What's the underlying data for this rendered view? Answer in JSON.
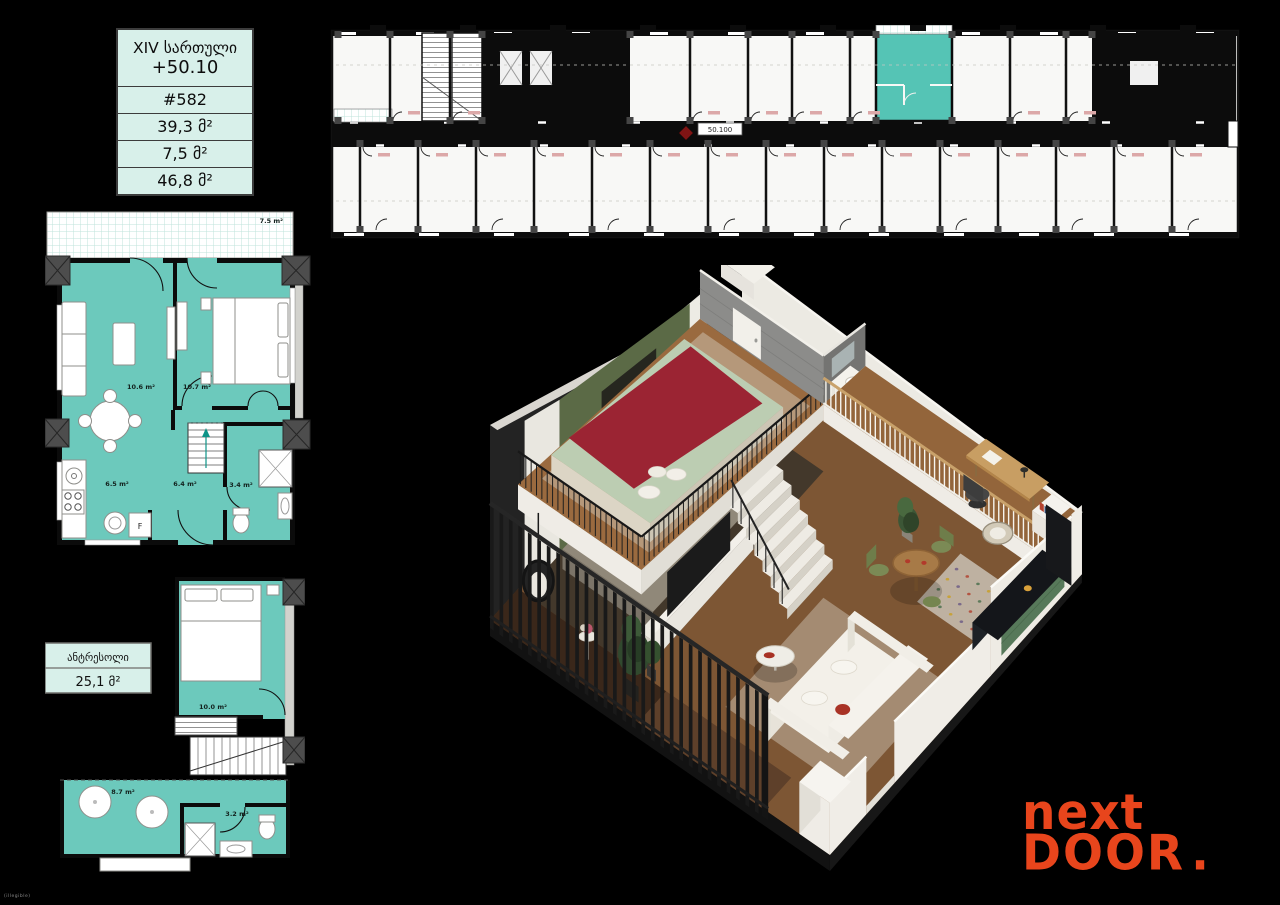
{
  "colors": {
    "background": "#000000",
    "teal_plan": "#6CC9BC",
    "teal_unit_highlight": "#55C4B5",
    "mint_table_bg": "#D8F0EA",
    "plan_wall": "#0B0B0B",
    "column_gray": "#4D4D4D",
    "logo_orange": "#E8451C",
    "marker_red": "#7E1414"
  },
  "info_table": {
    "floor_label": "XIV სართული",
    "elevation": "+50.10",
    "unit_number": "#582",
    "area_living": "39,3 მ²",
    "area_balcony": "7,5 მ²",
    "area_total": "46,8 მ²"
  },
  "key_plan": {
    "marker_label": "50.100"
  },
  "main_plan": {
    "balcony": "7.5 m²",
    "living": "10.6 m²",
    "bedroom": "10.7 m²",
    "kitchen": "6.5 m²",
    "hall": "6.4 m²",
    "bathroom": "3.4 m²",
    "fridge": "F"
  },
  "mezzanine_plan": {
    "title": "ანტრესოლი",
    "total_area": "25,1 მ²",
    "bedroom": "10.0 m²",
    "lounge": "8.7 m²",
    "bathroom": "3.2 m²"
  },
  "logo": {
    "top": "next",
    "bottom": "DOOR",
    "dot": "."
  },
  "fine_print": "(illegible)"
}
